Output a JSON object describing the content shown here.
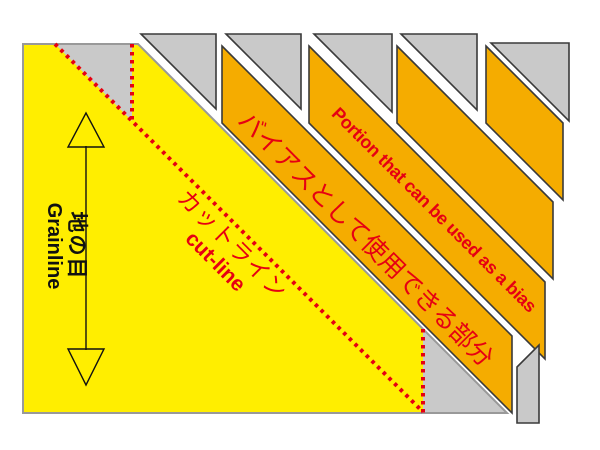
{
  "labels": {
    "grainline_jp": "地の目",
    "grainline_en": "Grainline",
    "cutline_jp": "カットライン",
    "cutline_en": "cut-line",
    "bias_jp": "バイアスとして使用できる部分",
    "bias_en": "Portion that can be used as a bias"
  },
  "colors": {
    "background": "#FFFFFF",
    "fabric_yellow": "#FFEE00",
    "bias_amber": "#F5AC00",
    "waste_gray": "#C9C9C9",
    "outline_dark": "#3A3A3A",
    "fabric_border": "#999999",
    "cut_red": "#E60012",
    "text_black": "#111111"
  }
}
